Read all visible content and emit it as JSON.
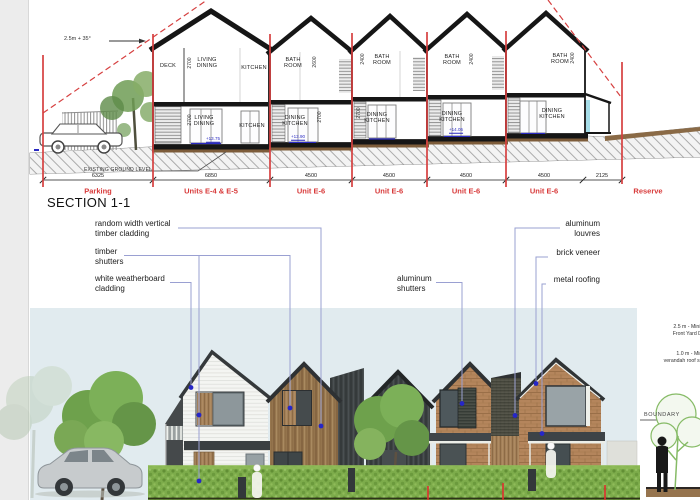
{
  "colors": {
    "accent_red": "#d64040",
    "leader_line": "#9aa0d2",
    "dot_blue": "#2626c8",
    "sky": "#e1ebef",
    "brick": "#b4855c",
    "timber": "#9c7b52",
    "dark_cladding": "#3f4445",
    "hedge_green": "#7dac4b",
    "white_cladding": "#f3f4f1"
  },
  "section": {
    "title": "SECTION 1-1",
    "slope_note": "2.5m + 35°",
    "ground_note": "EXISTING GROUND LEVEL",
    "rooms": [
      {
        "t": "DECK",
        "x": 168,
        "y": 66
      },
      {
        "t": "LIVING\nDINING",
        "x": 207,
        "y": 63
      },
      {
        "t": "KITCHEN",
        "x": 254,
        "y": 68
      },
      {
        "t": "LIVING\nDINING",
        "x": 204,
        "y": 121
      },
      {
        "t": "KITCHEN",
        "x": 252,
        "y": 126
      },
      {
        "t": "BATH\nROOM",
        "x": 293,
        "y": 63
      },
      {
        "t": "DINING\nKITCHEN",
        "x": 295,
        "y": 121
      },
      {
        "t": "BATH\nROOM",
        "x": 382,
        "y": 60
      },
      {
        "t": "DINING\nKITCHEN",
        "x": 377,
        "y": 118
      },
      {
        "t": "BATH\nROOM",
        "x": 452,
        "y": 60
      },
      {
        "t": "DINING\nKITCHEN",
        "x": 452,
        "y": 117
      },
      {
        "t": "BATH\nROOM",
        "x": 560,
        "y": 59
      },
      {
        "t": "DINING\nKITCHEN",
        "x": 552,
        "y": 114
      }
    ],
    "vdims": [
      {
        "t": "2700",
        "x": 190,
        "y": 63
      },
      {
        "t": "2700",
        "x": 190,
        "y": 120
      },
      {
        "t": "2600",
        "x": 315,
        "y": 62
      },
      {
        "t": "2700",
        "x": 320,
        "y": 117
      },
      {
        "t": "2400",
        "x": 363,
        "y": 59
      },
      {
        "t": "2700",
        "x": 359,
        "y": 113
      },
      {
        "t": "2400",
        "x": 472,
        "y": 59
      },
      {
        "t": "2400",
        "x": 573,
        "y": 58
      }
    ],
    "hdims": [
      {
        "t": "6325",
        "x": 98
      },
      {
        "t": "6850",
        "x": 211
      },
      {
        "t": "4500",
        "x": 311
      },
      {
        "t": "4500",
        "x": 389
      },
      {
        "t": "4500",
        "x": 466
      },
      {
        "t": "4500",
        "x": 544
      },
      {
        "t": "2125",
        "x": 602
      }
    ],
    "lots": [
      {
        "t": "Parking",
        "x": 98
      },
      {
        "t": "Units E-4 & E-5",
        "x": 211
      },
      {
        "t": "Unit E-6",
        "x": 311
      },
      {
        "t": "Unit E-6",
        "x": 389
      },
      {
        "t": "Unit E-6",
        "x": 466
      },
      {
        "t": "Unit E-6",
        "x": 544
      },
      {
        "t": "Reserve",
        "x": 648
      }
    ],
    "levels": [
      {
        "t": "+13.75",
        "x": 213,
        "y": 139
      },
      {
        "t": "+13.90",
        "x": 298,
        "y": 137
      },
      {
        "t": "+14.05",
        "x": 456,
        "y": 130
      }
    ]
  },
  "annotations": {
    "left": [
      {
        "t": "random width vertical\ntimber cladding"
      },
      {
        "t": "timber\nshutters"
      },
      {
        "t": "white weatherboard\ncladding"
      }
    ],
    "mid": [
      {
        "t": "aluminum\nshutters"
      }
    ],
    "right": [
      {
        "t": "aluminum\nlouvres"
      },
      {
        "t": "brick veneer"
      },
      {
        "t": "metal roofing"
      }
    ]
  },
  "render": {
    "boundary_label": "BOUNDARY",
    "notes": [
      {
        "t": "2.5 m - Minimum\nFront Yard Depth"
      },
      {
        "t": "1.0 m - Minimum\nverandah roof setback"
      }
    ]
  }
}
